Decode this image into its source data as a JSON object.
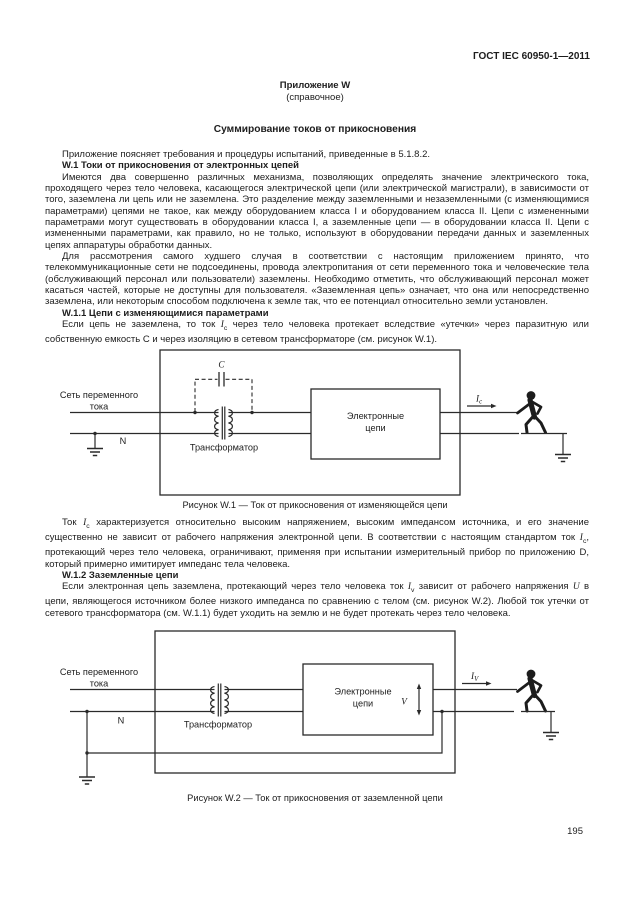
{
  "page": {
    "header_right": "ГОСТ IEC 60950-1—2011",
    "page_number": "195"
  },
  "annex": {
    "line1": "Приложение W",
    "line2": "(справочное)",
    "heading": "Суммирование токов от прикосновения"
  },
  "symbols": {
    "Ic": {
      "base": "I",
      "sub": "c"
    },
    "Iv": {
      "base": "I",
      "sub": "v"
    },
    "U": {
      "base": "U"
    }
  },
  "content": {
    "intro": [
      {
        "text": "Приложение поясняет требования и процедуры испытаний, приведенные в 5.1.8.2."
      },
      {
        "h": true,
        "text": "W.1 Токи от прикосновения от электронных цепей"
      },
      {
        "text": "Имеются два совершенно различных механизма, позволяющих определять значение электрического тока, проходящего через тело человека, касающегося электрической цепи (или электрической магистрали), в зависимости от того, заземлена ли цепь или не заземлена. Это разделение между заземленными и незаземленными (с изменяющимися параметрами) цепями не такое, как между оборудованием класса I и оборудованием класса II. Цепи с измененными параметрами могут существовать в оборудовании класса I, а заземленные цепи — в оборудовании класса II. Цепи с измененными параметрами, как правило, но не только, используют в оборудовании передачи данных и заземленных цепях аппаратуры обработки данных."
      },
      {
        "text": "Для рассмотрения самого худшего случая в соответствии с настоящим приложением принято, что телекоммуникационные сети не подсоединены, провода электропитания от сети переменного тока и человеческие тела (обслуживающий персонал или пользователи) заземлены. Необходимо отметить, что обслуживающий персонал может касаться частей, которые не доступны для пользователя. «Заземленная цепь» означает, что она или непосредственно заземлена, или некоторым способом подключена к земле так, что ее потенциал относительно земли установлен."
      },
      {
        "h": true,
        "text": "W.1.1 Цепи с изменяющимися параметрами"
      },
      {
        "text": "Если цепь не заземлена, то ток {{Ic}} через тело человека протекает вследствие «утечки» через паразитную или собственную емкость C и через изоляцию в сетевом трансформаторе (см. рисунок W.1)."
      }
    ],
    "mid": [
      {
        "text": "Ток {{Ic}} характеризуется относительно высоким напряжением, высоким импедансом источника, и его значение существенно не зависит от рабочего напряжения электронной цепи. В соответствии с настоящим стандартом ток {{Ic}}, протекающий через тело человека, ограничивают, применяя при испытании измерительный прибор по приложению D, который примерно имитирует импеданс тела человека."
      },
      {
        "h": true,
        "text": "W.1.2 Заземленные цепи"
      },
      {
        "text": "Если электронная цепь заземлена, протекающий через тело человека ток {{Iv}} зависит от рабочего напряжения {{U}} в цепи, являющегося источником более низкого импеданса по сравнению с телом (см. рисунок W.2). Любой ток утечки от сетевого трансформатора (см. W.1.1) будет уходить на землю и не будет протекать через тело человека."
      }
    ]
  },
  "captions": {
    "fig1": "Рисунок W.1 — Ток от прикосновения от изменяющейся цепи",
    "fig2": "Рисунок W.2 — Ток от прикосновения от заземленной цепи"
  },
  "figures": {
    "fig1": {
      "mains_label": [
        "Сеть переменного",
        "тока"
      ],
      "neutral_label": "N",
      "capacitor_label": "C",
      "transformer_label": "Трансформатор",
      "circuit_box_label": [
        "Электронные",
        "цепи"
      ],
      "current_label": {
        "base": "I",
        "sub": "c"
      }
    },
    "fig2": {
      "mains_label": [
        "Сеть переменного",
        "тока"
      ],
      "neutral_label": "N",
      "transformer_label": "Трансформатор",
      "circuit_box_label": [
        "Электронные",
        "цепи"
      ],
      "voltage_label": "V",
      "current_label": {
        "base": "I",
        "sub": "V"
      }
    }
  },
  "colors": {
    "ink": "#1d1d1d",
    "line": "#2a2a2a",
    "background": "#ffffff"
  }
}
